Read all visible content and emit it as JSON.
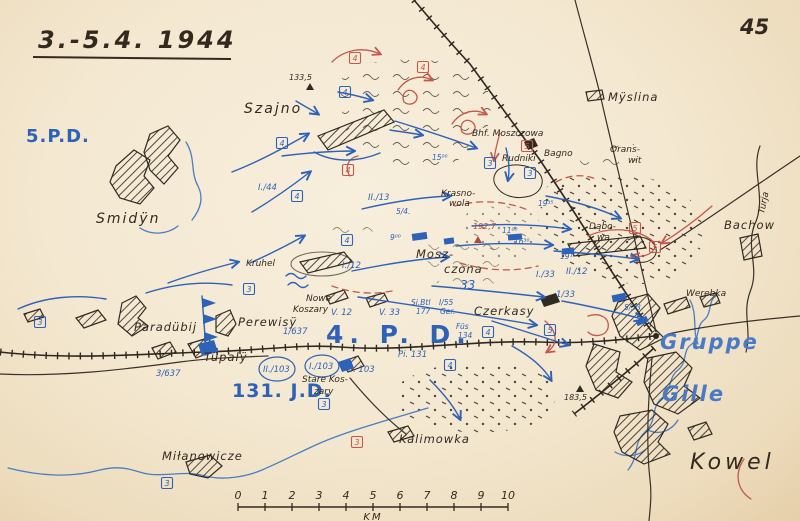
{
  "page": {
    "title": "3.-5.4. 1944",
    "number": "45"
  },
  "colors": {
    "paper": "#f4e9d4",
    "ink": "#33291e",
    "blue": "#2d62b8",
    "red": "#c3584b",
    "river_blue": "#4a7ec2"
  },
  "map": {
    "scale_bar": {
      "unit": "KM",
      "labels": [
        "0",
        "1",
        "2",
        "3",
        "4",
        "5",
        "6",
        "7",
        "8",
        "9",
        "10"
      ],
      "x0": 238,
      "step": 27,
      "y": 507
    },
    "labels": [
      {
        "t": "5.P.D.",
        "x": 26,
        "y": 142,
        "c": "fmt-lg"
      },
      {
        "t": "4. P. D.",
        "x": 326,
        "y": 343,
        "c": "fmt-xl"
      },
      {
        "t": "131. J.D.",
        "x": 232,
        "y": 397,
        "c": "fmt-md"
      },
      {
        "t": "Gruppe",
        "x": 660,
        "y": 349,
        "c": "fmt-script"
      },
      {
        "t": "Gille",
        "x": 662,
        "y": 401,
        "c": "fmt-script"
      },
      {
        "t": "Szajno",
        "x": 244,
        "y": 113,
        "c": "place-lg"
      },
      {
        "t": "Smidÿn",
        "x": 96,
        "y": 223,
        "c": "place-lg"
      },
      {
        "t": "Mÿslina",
        "x": 608,
        "y": 101,
        "c": "place-md"
      },
      {
        "t": "Bhf. Moszczowa",
        "x": 472,
        "y": 136,
        "c": "place-sm"
      },
      {
        "t": "Rudniki",
        "x": 502,
        "y": 161,
        "c": "place-sm"
      },
      {
        "t": "Bagno",
        "x": 544,
        "y": 156,
        "c": "place-sm"
      },
      {
        "t": "Orans-",
        "x": 610,
        "y": 152,
        "c": "place-sm"
      },
      {
        "t": "wit",
        "x": 628,
        "y": 163,
        "c": "place-sm"
      },
      {
        "t": "Krasno-",
        "x": 441,
        "y": 196,
        "c": "place-sm"
      },
      {
        "t": "wola",
        "x": 449,
        "y": 206,
        "c": "place-sm"
      },
      {
        "t": "Mosz-",
        "x": 416,
        "y": 258,
        "c": "place-md"
      },
      {
        "t": "czona",
        "x": 444,
        "y": 273,
        "c": "place-md"
      },
      {
        "t": "Kruhel",
        "x": 246,
        "y": 266,
        "c": "place-sm"
      },
      {
        "t": "Nowe",
        "x": 306,
        "y": 301,
        "c": "place-sm"
      },
      {
        "t": "Koszary",
        "x": 293,
        "y": 312,
        "c": "place-sm"
      },
      {
        "t": "Czerkasy",
        "x": 474,
        "y": 315,
        "c": "place-md"
      },
      {
        "t": "Dąbo-",
        "x": 589,
        "y": 229,
        "c": "place-sm"
      },
      {
        "t": "wa",
        "x": 597,
        "y": 240,
        "c": "place-sm"
      },
      {
        "t": "Bachow",
        "x": 724,
        "y": 229,
        "c": "place-md"
      },
      {
        "t": "Werebka",
        "x": 686,
        "y": 296,
        "c": "place-sm"
      },
      {
        "t": "Turja",
        "x": 764,
        "y": 214,
        "c": "place-sm",
        "r": -78
      },
      {
        "t": "Paradübij",
        "x": 134,
        "y": 331,
        "c": "place-md"
      },
      {
        "t": "Perewisÿ",
        "x": 238,
        "y": 326,
        "c": "place-md"
      },
      {
        "t": "Tüpalÿ",
        "x": 204,
        "y": 361,
        "c": "place-md"
      },
      {
        "t": "Stare Kos-",
        "x": 302,
        "y": 382,
        "c": "place-sm"
      },
      {
        "t": "zary",
        "x": 314,
        "y": 394,
        "c": "place-sm"
      },
      {
        "t": "Kalimowka",
        "x": 399,
        "y": 443,
        "c": "place-md"
      },
      {
        "t": "Miłanowicze",
        "x": 162,
        "y": 460,
        "c": "place-md"
      },
      {
        "t": "Kowel",
        "x": 690,
        "y": 469,
        "c": "place-xl"
      },
      {
        "t": "133,5",
        "x": 289,
        "y": 80,
        "c": "height"
      },
      {
        "t": "192,7",
        "x": 473,
        "y": 229,
        "c": "height-red"
      },
      {
        "t": "183,5",
        "x": 564,
        "y": 400,
        "c": "height"
      },
      {
        "t": "I./44",
        "x": 258,
        "y": 190,
        "c": "unit"
      },
      {
        "t": "II./13",
        "x": 368,
        "y": 200,
        "c": "unit"
      },
      {
        "t": "I./12",
        "x": 342,
        "y": 268,
        "c": "unit"
      },
      {
        "t": "5/4.",
        "x": 396,
        "y": 214,
        "c": "unit-sm"
      },
      {
        "t": "V. 12",
        "x": 331,
        "y": 315,
        "c": "unit"
      },
      {
        "t": "V. 33",
        "x": 379,
        "y": 315,
        "c": "unit"
      },
      {
        "t": "Si.Btl",
        "x": 411,
        "y": 305,
        "c": "unit-sm"
      },
      {
        "t": "177",
        "x": 416,
        "y": 314,
        "c": "unit-sm"
      },
      {
        "t": "I/55",
        "x": 439,
        "y": 305,
        "c": "unit-sm"
      },
      {
        "t": "Ger.",
        "x": 440,
        "y": 314,
        "c": "unit-sm"
      },
      {
        "t": "Füs",
        "x": 456,
        "y": 329,
        "c": "unit-sm"
      },
      {
        "t": "134",
        "x": 458,
        "y": 338,
        "c": "unit-sm"
      },
      {
        "t": "Pi. 131",
        "x": 398,
        "y": 357,
        "c": "unit"
      },
      {
        "t": "1/637",
        "x": 283,
        "y": 334,
        "c": "unit"
      },
      {
        "t": "3/637",
        "x": 156,
        "y": 376,
        "c": "unit"
      },
      {
        "t": "II./103",
        "x": 263,
        "y": 372,
        "c": "unit"
      },
      {
        "t": "I./103",
        "x": 309,
        "y": 369,
        "c": "unit"
      },
      {
        "t": "II. 103",
        "x": 348,
        "y": 372,
        "c": "unit"
      },
      {
        "t": "I./33",
        "x": 536,
        "y": 277,
        "c": "unit"
      },
      {
        "t": "1/33",
        "x": 556,
        "y": 297,
        "c": "unit"
      },
      {
        "t": "II./12",
        "x": 566,
        "y": 274,
        "c": "unit"
      },
      {
        "t": "5/33",
        "x": 624,
        "y": 310,
        "c": "unit-sm"
      },
      {
        "t": "33",
        "x": 460,
        "y": 289,
        "c": "unit-lg"
      },
      {
        "t": "15⁰⁰",
        "x": 432,
        "y": 160,
        "c": "time"
      },
      {
        "t": "9⁰⁰",
        "x": 390,
        "y": 240,
        "c": "time"
      },
      {
        "t": "11⁰⁰",
        "x": 502,
        "y": 233,
        "c": "time"
      },
      {
        "t": "16³⁰",
        "x": 514,
        "y": 244,
        "c": "time"
      },
      {
        "t": "19³⁵",
        "x": 538,
        "y": 206,
        "c": "time"
      },
      {
        "t": "19¹⁵",
        "x": 560,
        "y": 259,
        "c": "time"
      }
    ],
    "markers": [
      {
        "t": "3",
        "x": 40,
        "y": 322,
        "k": "blue"
      },
      {
        "t": "3",
        "x": 249,
        "y": 289,
        "k": "blue"
      },
      {
        "t": "3",
        "x": 490,
        "y": 163,
        "k": "blue"
      },
      {
        "t": "3",
        "x": 530,
        "y": 173,
        "k": "blue"
      },
      {
        "t": "3",
        "x": 324,
        "y": 404,
        "k": "blue"
      },
      {
        "t": "3",
        "x": 167,
        "y": 483,
        "k": "blue"
      },
      {
        "t": "4",
        "x": 282,
        "y": 143,
        "k": "blue"
      },
      {
        "t": "4",
        "x": 345,
        "y": 92,
        "k": "blue"
      },
      {
        "t": "4",
        "x": 297,
        "y": 196,
        "k": "blue"
      },
      {
        "t": "4",
        "x": 347,
        "y": 240,
        "k": "blue"
      },
      {
        "t": "4",
        "x": 488,
        "y": 332,
        "k": "blue"
      },
      {
        "t": "4",
        "x": 450,
        "y": 365,
        "k": "blue"
      },
      {
        "t": "5",
        "x": 550,
        "y": 330,
        "k": "blue"
      },
      {
        "t": "4",
        "x": 355,
        "y": 58,
        "k": "red"
      },
      {
        "t": "4",
        "x": 423,
        "y": 67,
        "k": "red"
      },
      {
        "t": "4",
        "x": 348,
        "y": 170,
        "k": "red"
      },
      {
        "t": "5",
        "x": 527,
        "y": 146,
        "k": "red"
      },
      {
        "t": "5",
        "x": 635,
        "y": 228,
        "k": "red"
      },
      {
        "t": "5",
        "x": 655,
        "y": 247,
        "k": "red"
      },
      {
        "t": "3",
        "x": 357,
        "y": 442,
        "k": "red"
      }
    ]
  }
}
